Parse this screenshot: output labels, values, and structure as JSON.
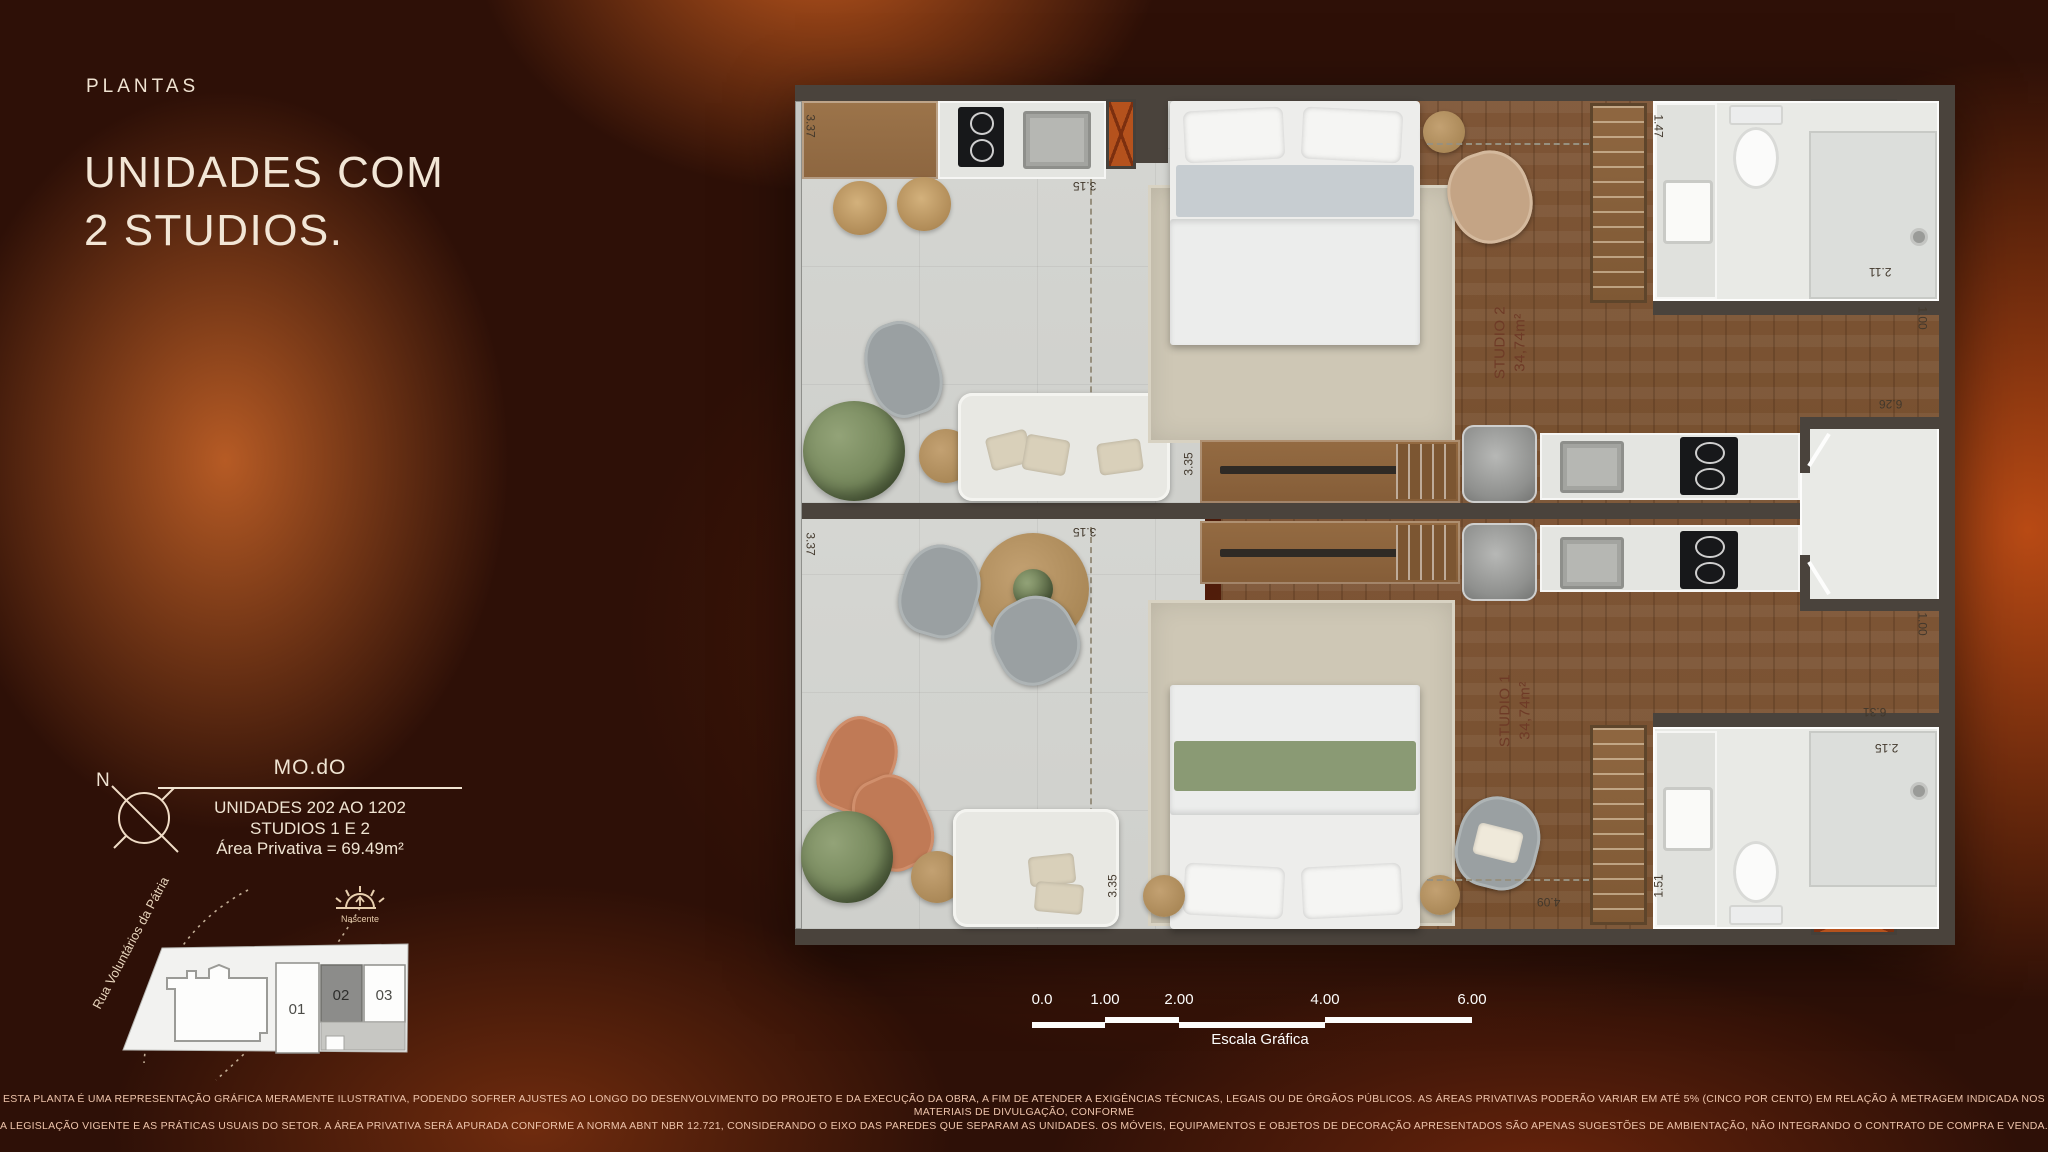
{
  "page": {
    "kicker": "PLANTAS",
    "title_line1": "UNIDADES COM",
    "title_line2": "2 STUDIOS."
  },
  "info_block": {
    "brand": "MO.dO",
    "line1": "UNIDADES 202 AO 1202",
    "line2": "STUDIOS 1 E 2",
    "line3": "Área Privativa = 69.49m²"
  },
  "compass": {
    "north_label": "N"
  },
  "site_plan": {
    "street_label": "Rua Voluntários da Pátria",
    "sun_label": "Nascente",
    "units": [
      "01",
      "02",
      "03"
    ],
    "highlighted_unit": "02"
  },
  "floor_plan": {
    "studio2": {
      "name": "STUDIO 2",
      "area": "34,74m²",
      "dims": {
        "w337": "3.37",
        "w315": "3.15",
        "k335": "3.35",
        "bath147": "1.47",
        "bath211": "2.11",
        "hall100": "1.00",
        "w626": "6.26"
      }
    },
    "studio1": {
      "name": "STUDIO 1",
      "area": "34,74m²",
      "dims": {
        "w337": "3.37",
        "w315": "3.15",
        "k335": "3.35",
        "hall100": "1.00",
        "w631": "6.31",
        "w215": "2.15",
        "bath151": "1.51",
        "w409": "4.09"
      }
    }
  },
  "scale_bar": {
    "ticks": [
      "0.0",
      "1.00",
      "2.00",
      "4.00",
      "6.00"
    ],
    "label": "Escala Gráfica"
  },
  "disclaimer": {
    "line1": "ESTA PLANTA É UMA REPRESENTAÇÃO GRÁFICA MERAMENTE ILUSTRATIVA, PODENDO SOFRER AJUSTES AO LONGO DO DESENVOLVIMENTO DO PROJETO E DA EXECUÇÃO DA OBRA, A FIM DE ATENDER A EXIGÊNCIAS TÉCNICAS, LEGAIS OU DE ÓRGÃOS PÚBLICOS. AS ÁREAS PRIVATIVAS PODERÃO VARIAR EM ATÉ 5% (CINCO POR CENTO) EM RELAÇÃO À METRAGEM INDICADA NOS MATERIAIS DE DIVULGAÇÃO, CONFORME",
    "line2": "A LEGISLAÇÃO VIGENTE E AS PRÁTICAS USUAIS DO SETOR. A ÁREA PRIVATIVA SERÁ APURADA CONFORME A NORMA ABNT NBR 12.721, CONSIDERANDO O EIXO DAS PAREDES QUE SEPARAM AS UNIDADES. OS MÓVEIS, EQUIPAMENTOS E OBJETOS DE DECORAÇÃO APRESENTADOS SÃO APENAS SUGESTÕES DE AMBIENTAÇÃO, NÃO INTEGRANDO O CONTRATO DE COMPRA E VENDA."
  },
  "colors": {
    "background_base": "#2e1007",
    "background_glow": "#c1571e",
    "text_cream": "#f2e6d6",
    "disclaimer_text": "#eec4ab",
    "wall": "#4a433c",
    "wood_floor": "#7d5435",
    "tile_floor": "#d5d6d2",
    "shaft_orange": "#b5521d",
    "studio_label_text": "#6e3a26"
  }
}
